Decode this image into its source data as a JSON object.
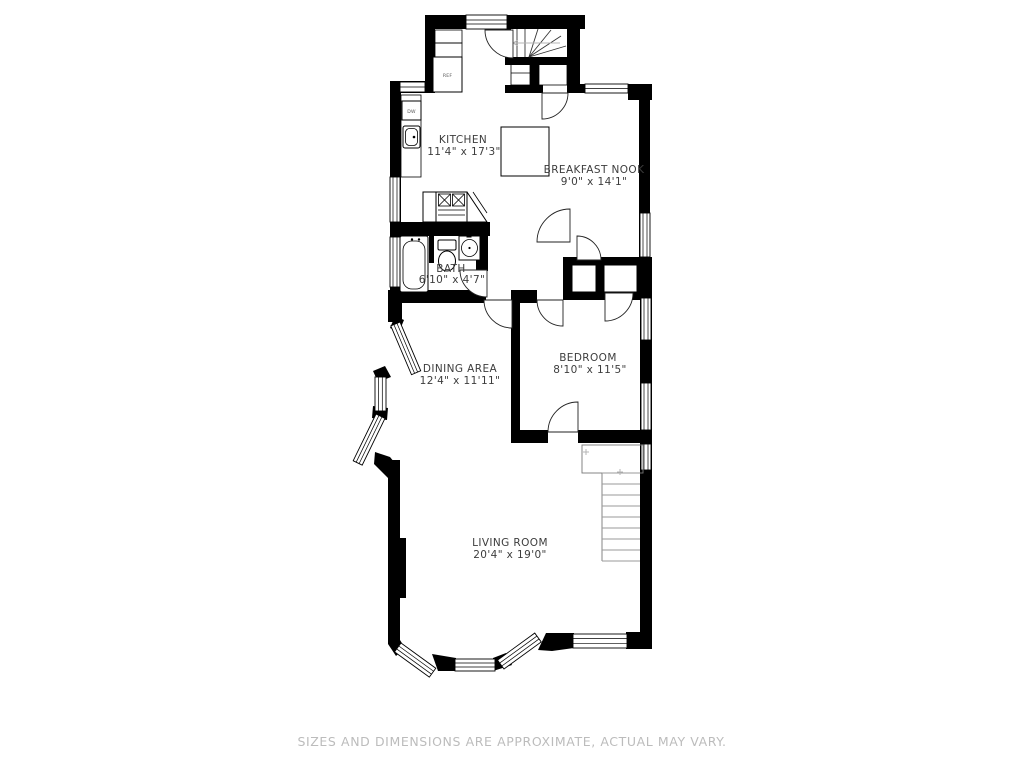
{
  "plan_title": "apartment-floor-plan",
  "rooms": [
    {
      "key": "kitchen",
      "name": "KITCHEN",
      "dims": "11'4\" x 17'3\""
    },
    {
      "key": "breakfast_nook",
      "name": "BREAKFAST NOOK",
      "dims": "9'0\" x 14'1\""
    },
    {
      "key": "bath",
      "name": "BATH",
      "dims": "6'10\" x 4'7\""
    },
    {
      "key": "dining_area",
      "name": "DINING AREA",
      "dims": "12'4\" x 11'11\""
    },
    {
      "key": "bedroom",
      "name": "BEDROOM",
      "dims": "8'10\" x 11'5\""
    },
    {
      "key": "living_room",
      "name": "LIVING ROOM",
      "dims": "20'4\" x 19'0\""
    }
  ],
  "appliances": {
    "refrigerator": "REF",
    "dishwasher": "DW"
  },
  "footer": {
    "disclaimer": "SIZES AND DIMENSIONS ARE APPROXIMATE, ACTUAL MAY VARY."
  },
  "colors": {
    "wall": "#000000",
    "label": "#3d3d3d",
    "disclaimer": "#bcbcbc",
    "tread_gray": "#9a9a9a"
  }
}
